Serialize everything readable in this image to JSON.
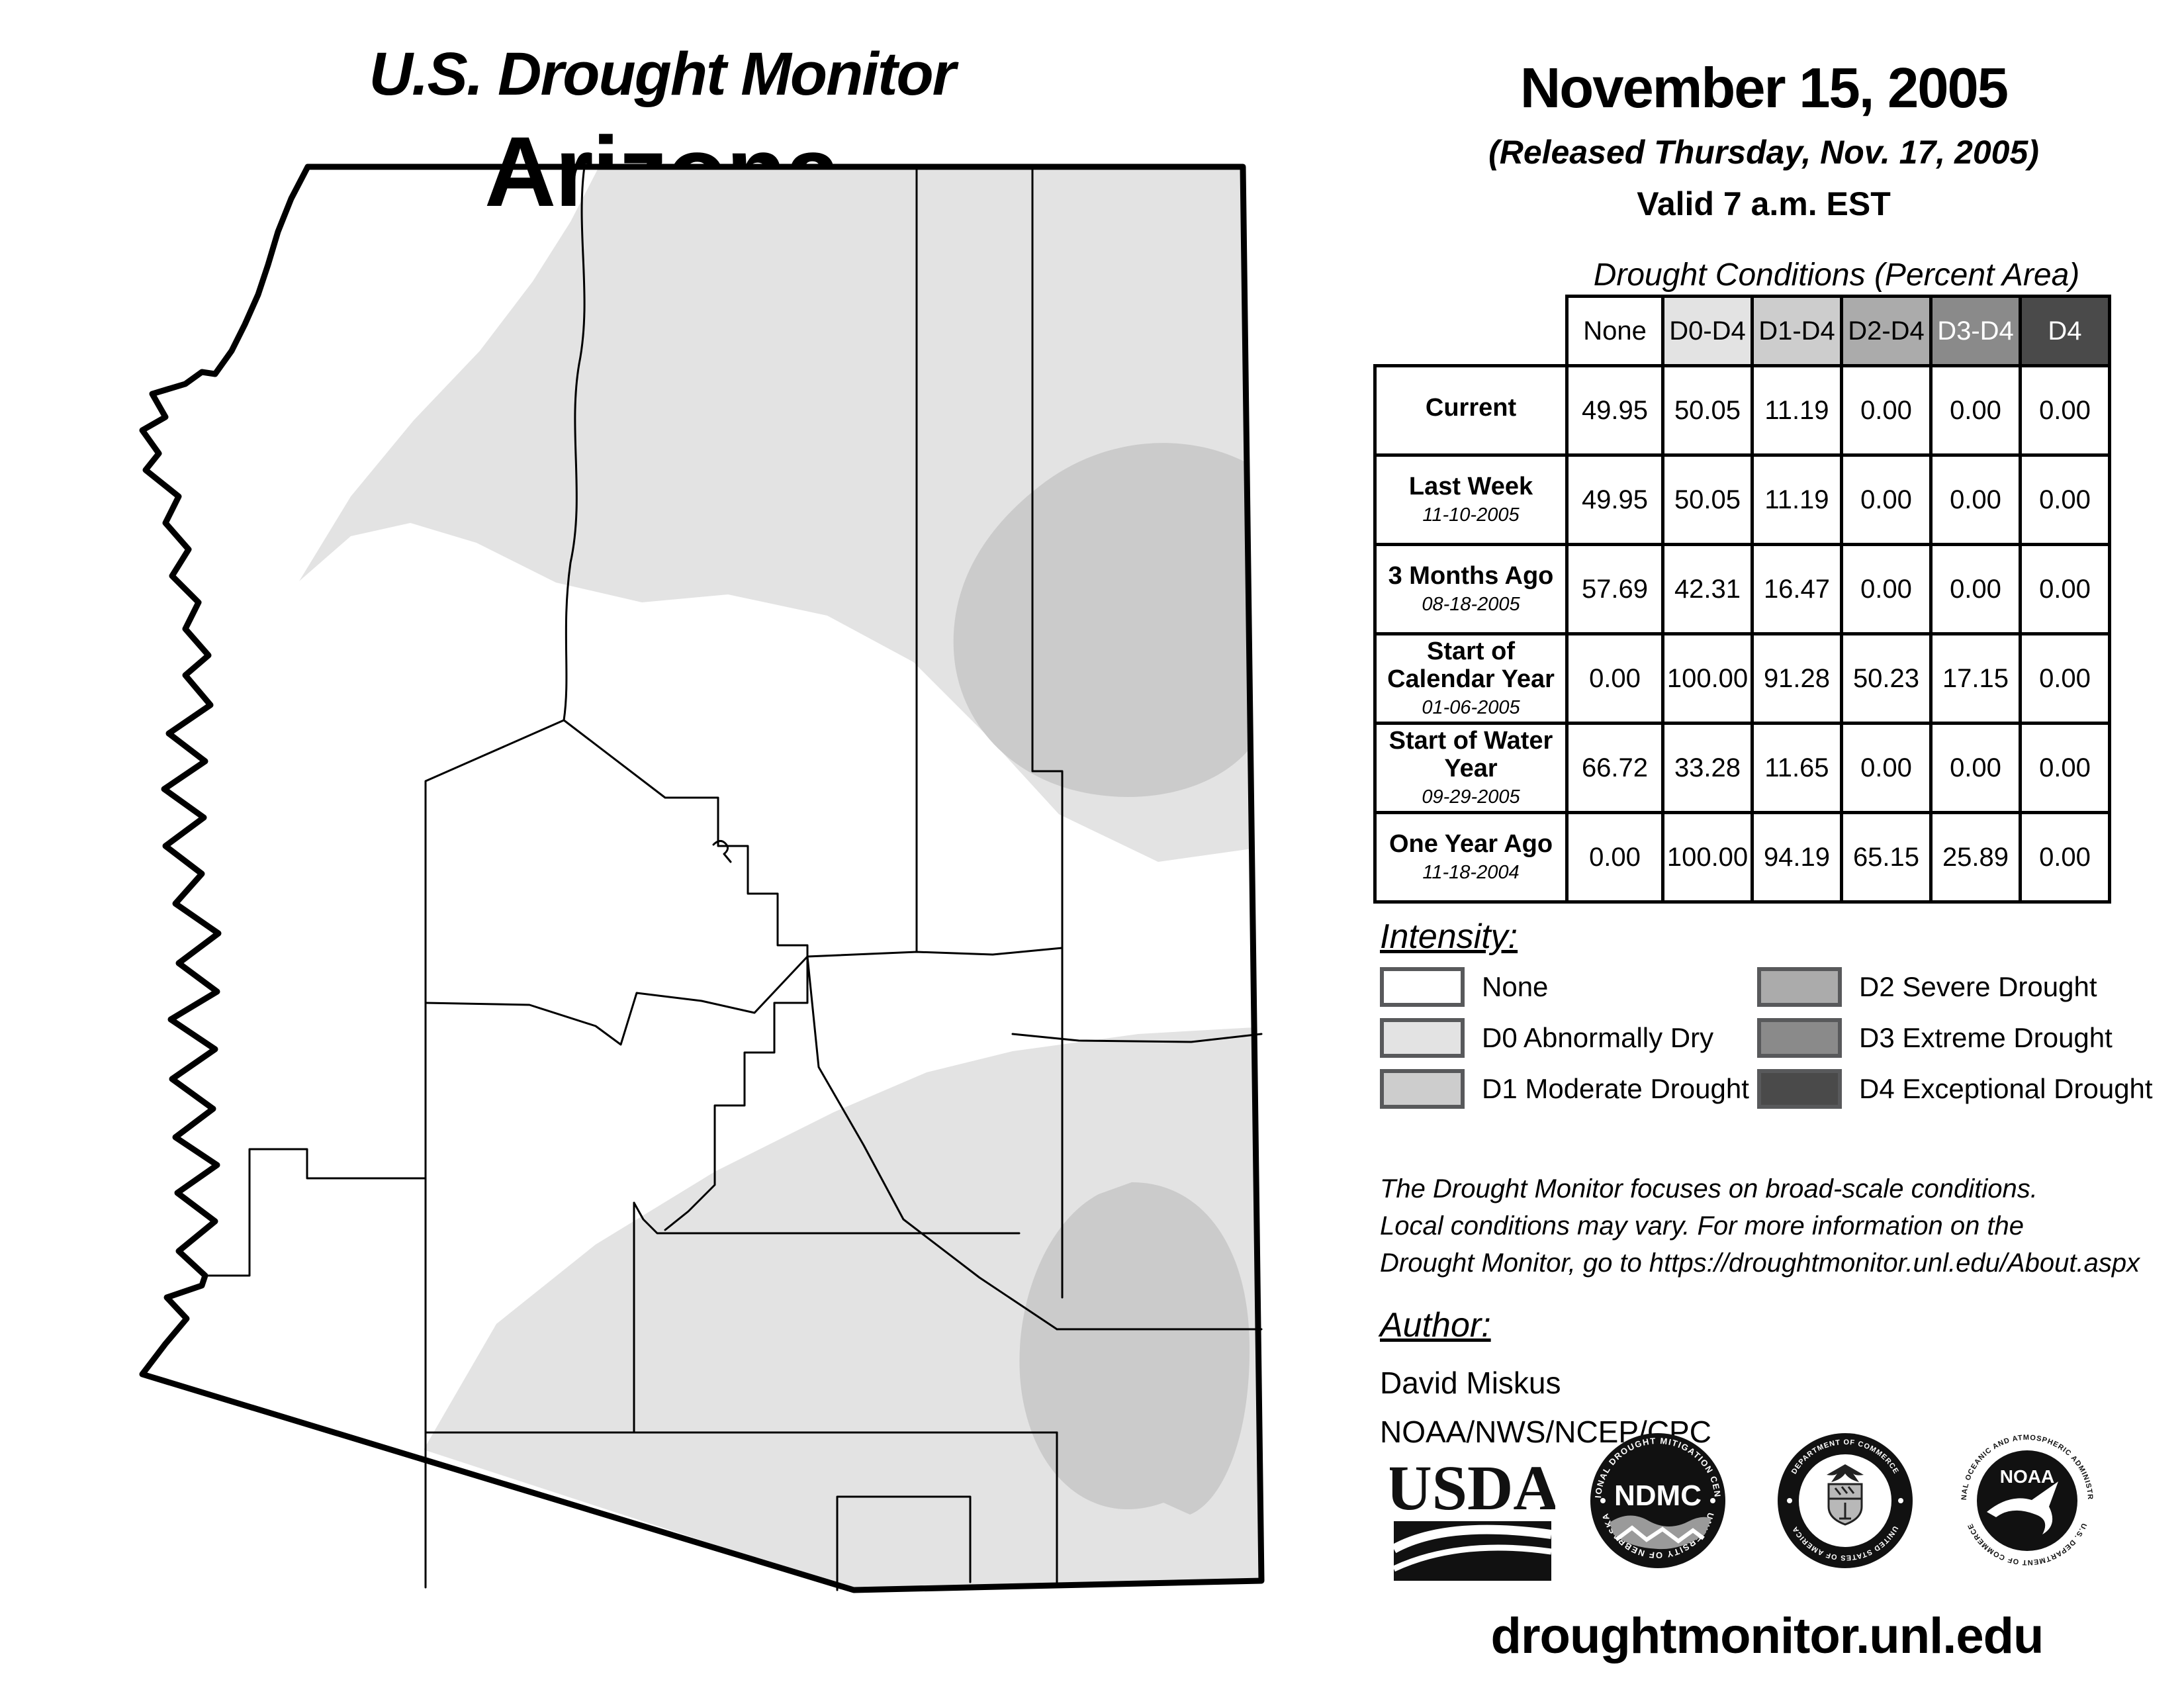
{
  "title": {
    "monitor": "U.S. Drought Monitor",
    "region": "Arizona"
  },
  "date_block": {
    "date": "November 15, 2005",
    "released": "(Released Thursday, Nov. 17, 2005)",
    "valid": "Valid 7 a.m. EST"
  },
  "table": {
    "caption": "Drought Conditions (Percent Area)",
    "columns": [
      "None",
      "D0-D4",
      "D1-D4",
      "D2-D4",
      "D3-D4",
      "D4"
    ],
    "column_colors": [
      "#ffffff",
      "#e3e3e3",
      "#cdcdcd",
      "#ababab",
      "#8a8a8a",
      "#4a4a4a"
    ],
    "column_text_colors": [
      "#000000",
      "#000000",
      "#000000",
      "#000000",
      "#ffffff",
      "#ffffff"
    ],
    "rows": [
      {
        "label": "Current",
        "date": "",
        "values": [
          "49.95",
          "50.05",
          "11.19",
          "0.00",
          "0.00",
          "0.00"
        ]
      },
      {
        "label": "Last Week",
        "date": "11-10-2005",
        "values": [
          "49.95",
          "50.05",
          "11.19",
          "0.00",
          "0.00",
          "0.00"
        ]
      },
      {
        "label": "3 Months Ago",
        "date": "08-18-2005",
        "values": [
          "57.69",
          "42.31",
          "16.47",
          "0.00",
          "0.00",
          "0.00"
        ]
      },
      {
        "label": "Start of Calendar Year",
        "date": "01-06-2005",
        "values": [
          "0.00",
          "100.00",
          "91.28",
          "50.23",
          "17.15",
          "0.00"
        ]
      },
      {
        "label": "Start of Water Year",
        "date": "09-29-2005",
        "values": [
          "66.72",
          "33.28",
          "11.65",
          "0.00",
          "0.00",
          "0.00"
        ]
      },
      {
        "label": "One Year Ago",
        "date": "11-18-2004",
        "values": [
          "0.00",
          "100.00",
          "94.19",
          "65.15",
          "25.89",
          "0.00"
        ]
      }
    ]
  },
  "legend": {
    "heading": "Intensity:",
    "items": [
      {
        "label": "None",
        "color": "#ffffff"
      },
      {
        "label": "D0 Abnormally Dry",
        "color": "#e3e3e3"
      },
      {
        "label": "D1 Moderate Drought",
        "color": "#cdcdcd"
      },
      {
        "label": "D2 Severe Drought",
        "color": "#ababab"
      },
      {
        "label": "D3 Extreme Drought",
        "color": "#8a8a8a"
      },
      {
        "label": "D4 Exceptional Drought",
        "color": "#4a4a4a"
      }
    ]
  },
  "disclaimer": {
    "lines": [
      "The Drought Monitor focuses on broad-scale conditions.",
      "Local conditions may vary. For more information on the",
      "Drought Monitor, go to https://droughtmonitor.unl.edu/About.aspx"
    ]
  },
  "author": {
    "heading": "Author:",
    "name": "David Miskus",
    "org": "NOAA/NWS/NCEP/CPC"
  },
  "logos": {
    "usda": {
      "text": "USDA"
    },
    "ndmc": {
      "text": "NDMC",
      "ring_top": "NATIONAL DROUGHT MITIGATION CENTER",
      "ring_bottom": "UNIVERSITY OF NEBRASKA"
    },
    "doc": {
      "ring_top": "DEPARTMENT OF COMMERCE",
      "ring_bottom": "UNITED STATES OF AMERICA"
    },
    "noaa": {
      "text": "NOAA",
      "ring_top": "NATIONAL OCEANIC AND ATMOSPHERIC ADMINISTRATION",
      "ring_bottom": "U.S. DEPARTMENT OF COMMERCE"
    }
  },
  "footer": {
    "url": "droughtmonitor.unl.edu"
  },
  "map": {
    "state": "Arizona",
    "colors": {
      "none": "#ffffff",
      "d0": "#e3e3e3",
      "d1": "#cbcbcb",
      "outline": "#000000"
    }
  }
}
